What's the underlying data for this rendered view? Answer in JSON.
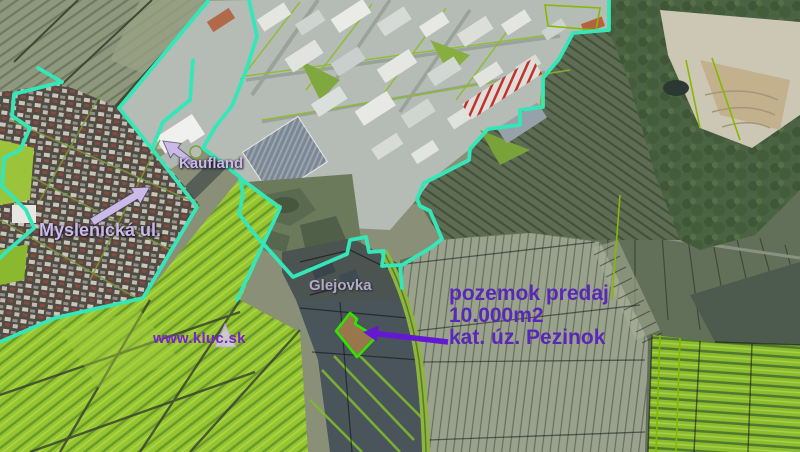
{
  "map": {
    "description": "aerial cadastral map of land for sale",
    "labels": {
      "kaufland": "Kaufland",
      "street": "Myslenická ul.",
      "area": "Glejovka",
      "website": "www.kluc.sk"
    },
    "ad": {
      "line1": "pozemok predaj",
      "line2": "10.000m2",
      "line3": "kat. úz. Pezinok"
    },
    "colors": {
      "boundary_cyan": "#35e7b8",
      "sale_parcel_outline": "#2fe400",
      "sale_parcel_fill": "#97774b",
      "annotation_violet": "#5a28b8",
      "label_lavender": "#cbb9e8",
      "vineyard_green": "#96c52f"
    },
    "icons": {
      "kaufland_arrow": "points to Kaufland store",
      "street_arrow": "points to Myslenická street",
      "parcel_arrow": "points to sale parcel",
      "logo_triangle": "kluc.sk triangle logo"
    }
  }
}
